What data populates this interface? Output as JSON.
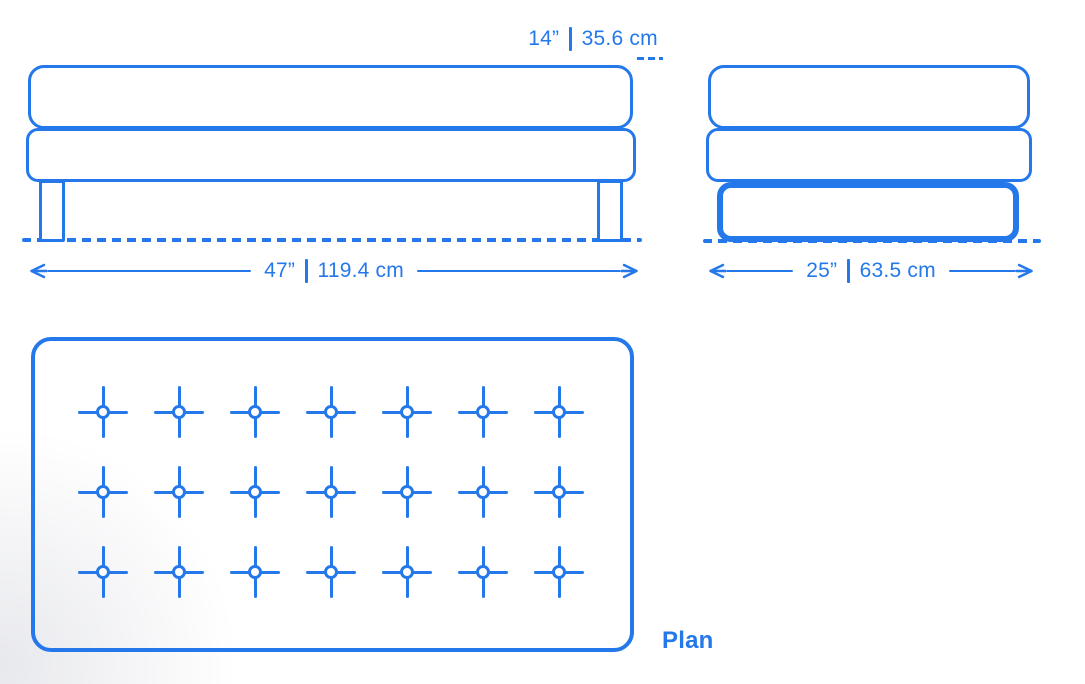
{
  "colors": {
    "primary": "#2478EA",
    "background": "#ffffff"
  },
  "front_view": {
    "height_dimension": {
      "imperial": "14”",
      "metric": "35.6 cm"
    },
    "width_dimension": {
      "imperial": "47”",
      "metric": "119.4 cm"
    }
  },
  "side_view": {
    "width_dimension": {
      "imperial": "25”",
      "metric": "63.5 cm"
    }
  },
  "plan_view": {
    "label": "Plan",
    "tufting_buttons": {
      "rows": 3,
      "columns": 7
    }
  }
}
